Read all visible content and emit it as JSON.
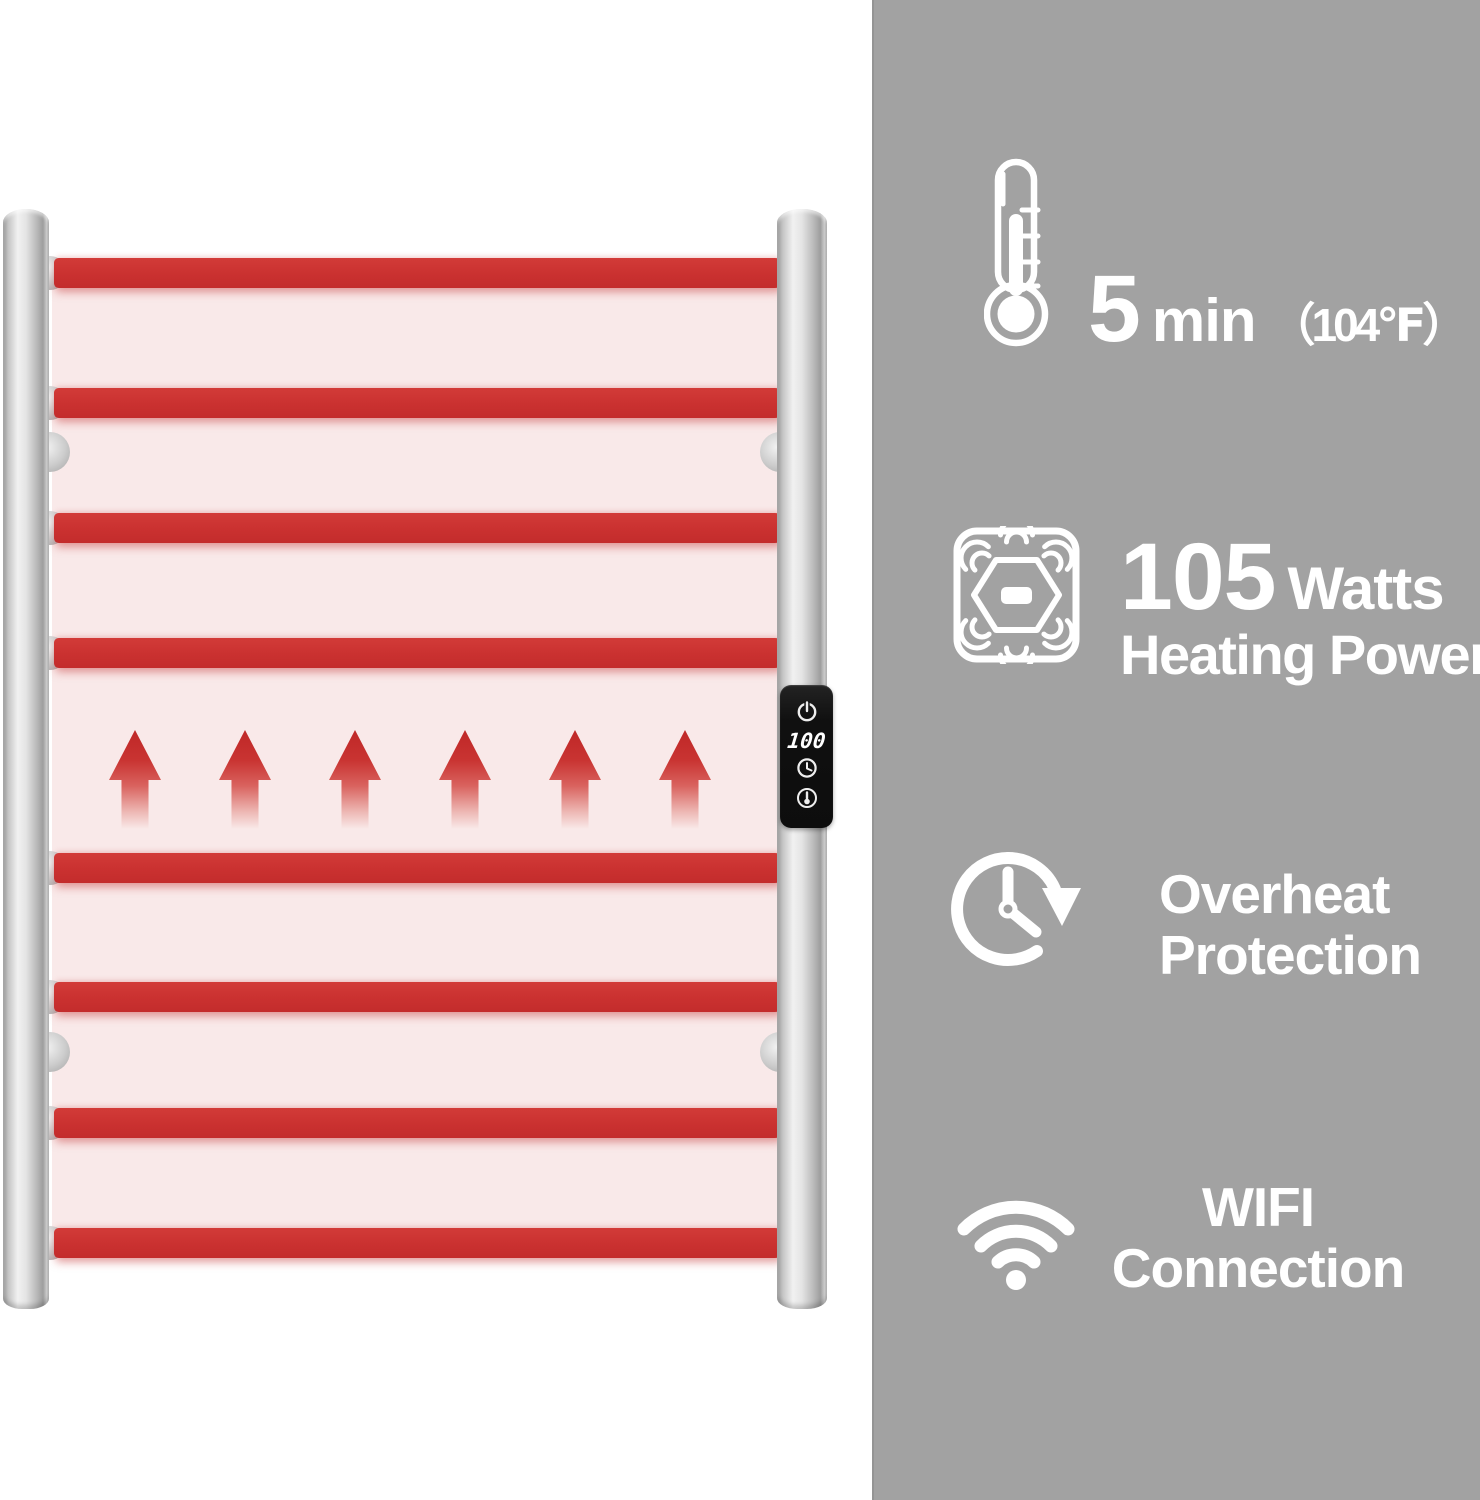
{
  "colors": {
    "accent_red": "#cb3434",
    "glow_pink": "#f9e9e9",
    "panel_gray": "#a2a2a2",
    "text_white": "#ffffff"
  },
  "rack": {
    "rung_count": 8,
    "arrow_count": 6,
    "control_panel": {
      "display_value": "100",
      "button_icons": [
        "power-icon",
        "timer-icon",
        "temperature-icon"
      ]
    }
  },
  "features": [
    {
      "icon": "thermometer-icon",
      "value": "5",
      "unit": "min",
      "note": "（104℉）"
    },
    {
      "icon": "heating-power-icon",
      "value": "105",
      "unit": "Watts",
      "label": "Heating Power"
    },
    {
      "icon": "overheat-protection-icon",
      "line1": "Overheat",
      "line2": "Protection"
    },
    {
      "icon": "wifi-icon",
      "line1": "WIFI",
      "line2": "Connection"
    }
  ]
}
